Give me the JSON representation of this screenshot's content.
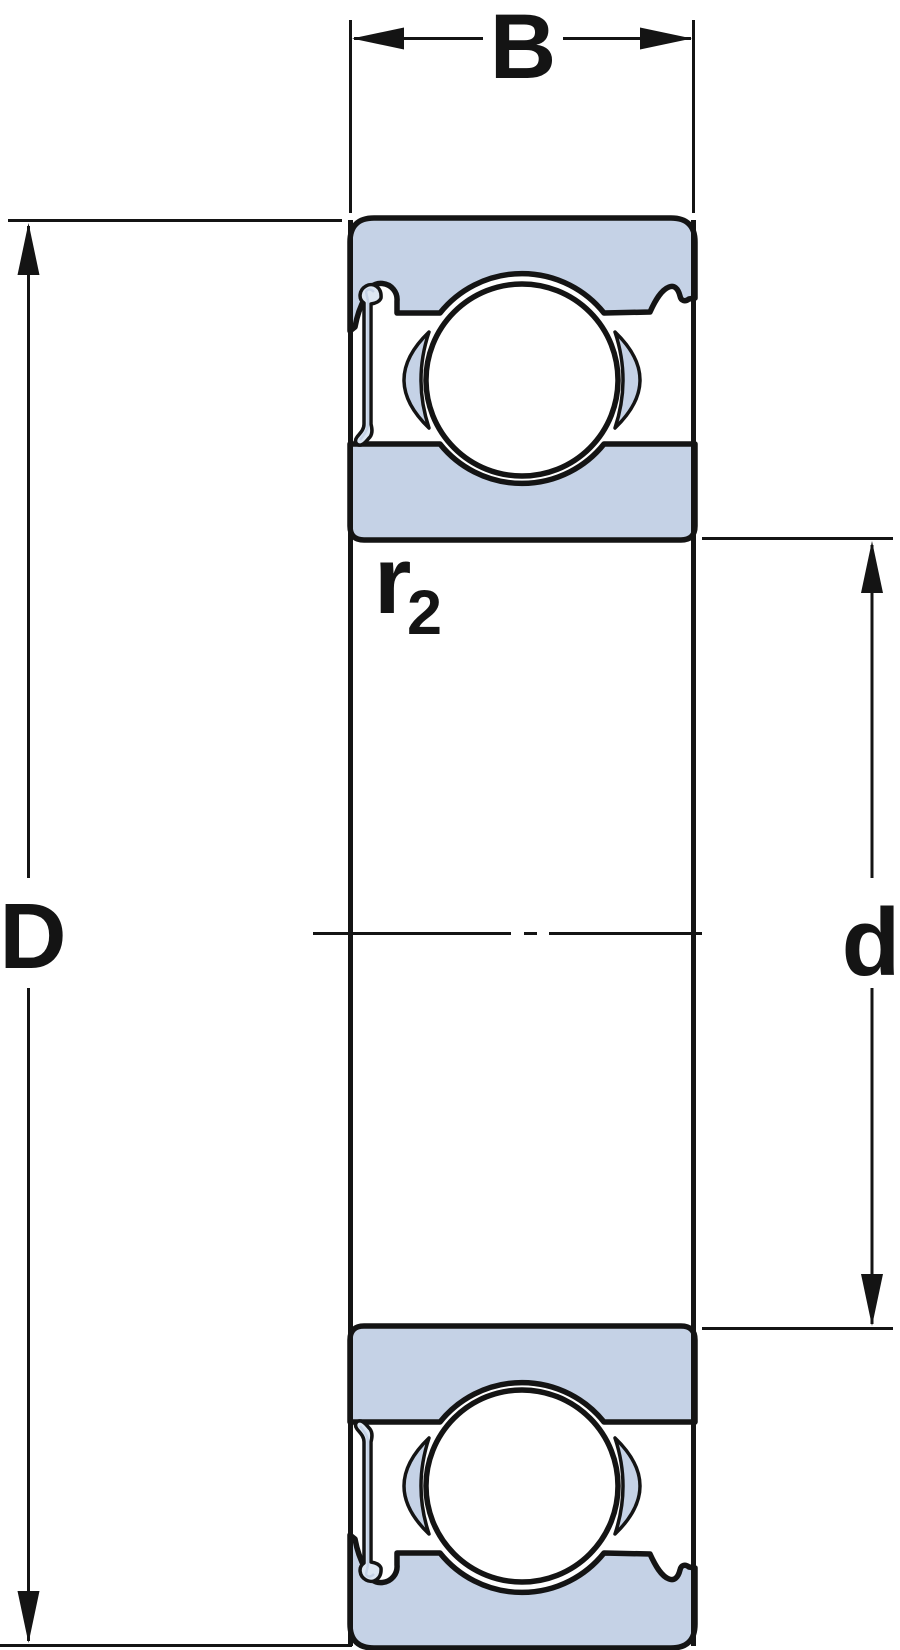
{
  "diagram": {
    "title": "deep-groove ball bearing cross-section",
    "labels": {
      "width": "B",
      "outer_diameter": "D",
      "bore_diameter": "d",
      "fillet_radius_base": "r",
      "fillet_radius_sub": "2"
    },
    "colors": {
      "line": "#141414",
      "ring_fill": "#c5d2e6",
      "shield_fill": "#dde7f3",
      "background": "#ffffff"
    }
  }
}
